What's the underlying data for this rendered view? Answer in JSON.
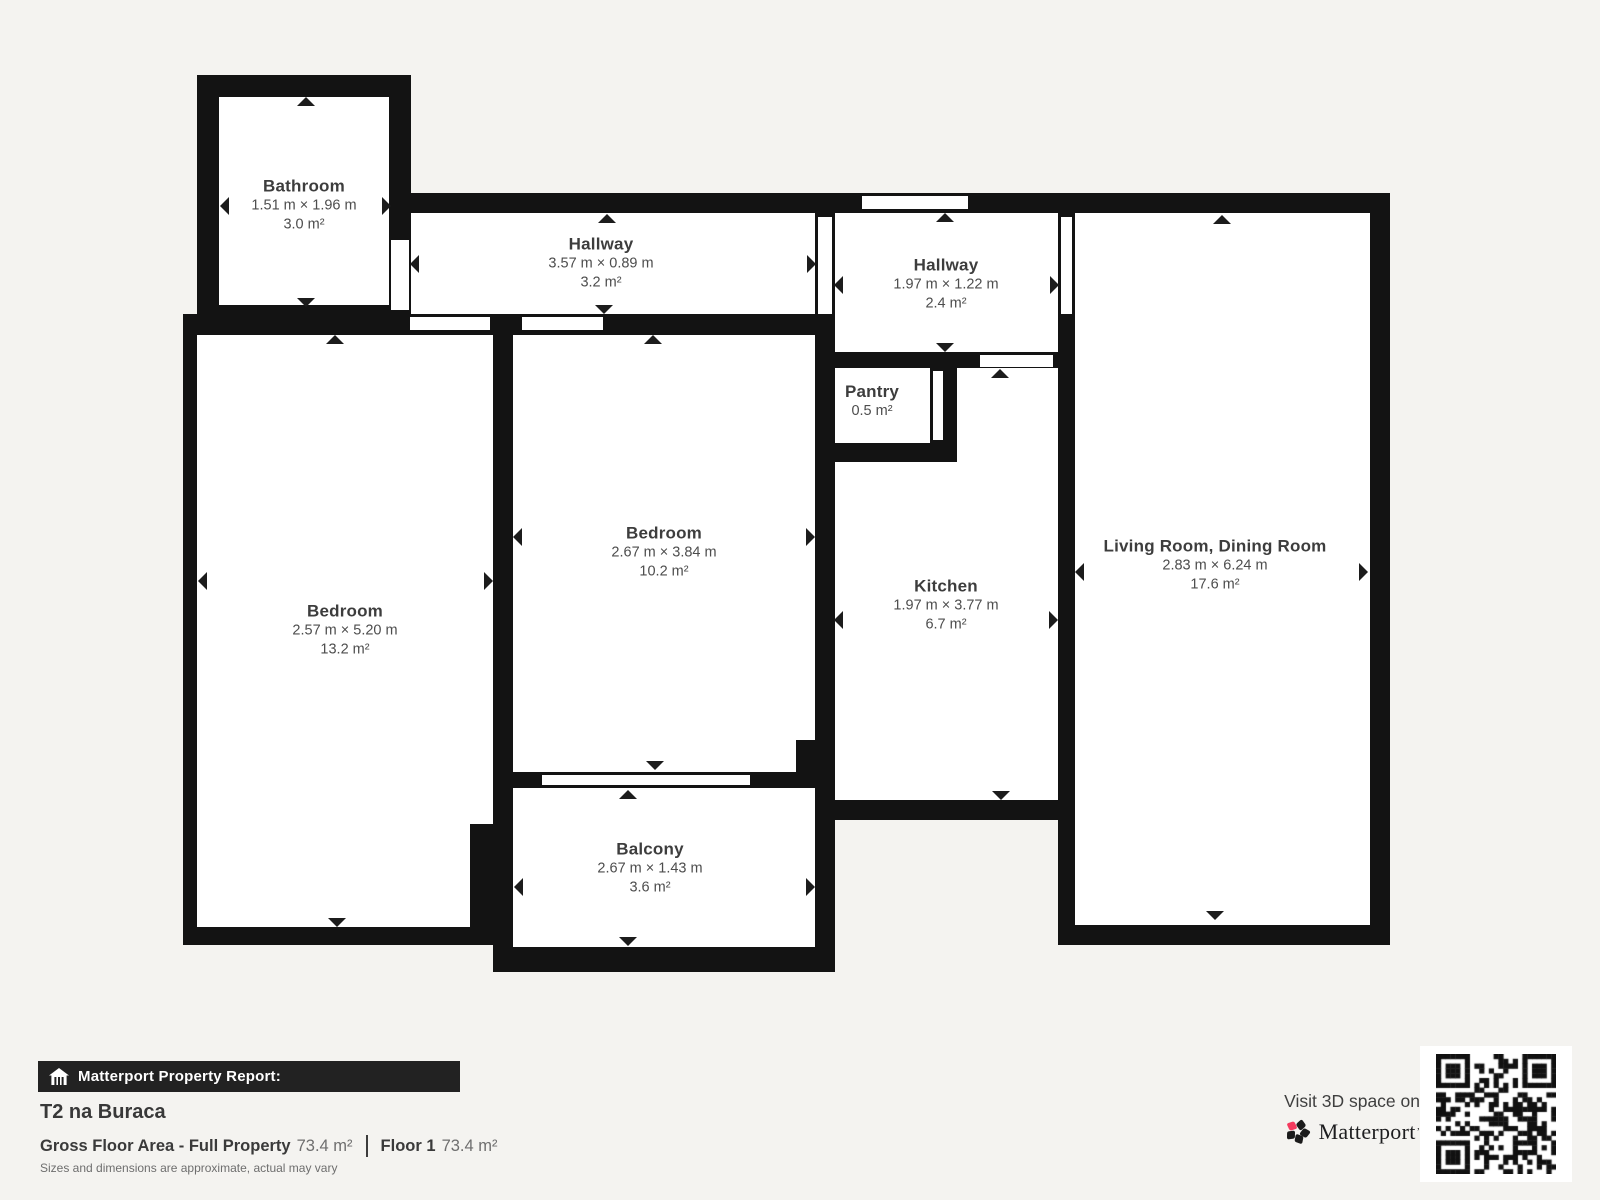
{
  "plan": {
    "rooms": [
      {
        "name": "Bathroom",
        "dims": "1.51 m × 1.96 m",
        "area": "3.0 m²"
      },
      {
        "name": "Hallway",
        "dims": "3.57 m × 0.89 m",
        "area": "3.2 m²"
      },
      {
        "name": "Hallway",
        "dims": "1.97 m × 1.22 m",
        "area": "2.4 m²"
      },
      {
        "name": "Pantry",
        "area": "0.5 m²"
      },
      {
        "name": "Bedroom",
        "dims": "2.57 m × 5.20 m",
        "area": "13.2 m²"
      },
      {
        "name": "Bedroom",
        "dims": "2.67 m × 3.84 m",
        "area": "10.2 m²"
      },
      {
        "name": "Kitchen",
        "dims": "1.97 m × 3.77 m",
        "area": "6.7 m²"
      },
      {
        "name": "Living Room, Dining Room",
        "dims": "2.83 m × 6.24 m",
        "area": "17.6 m²"
      },
      {
        "name": "Balcony",
        "dims": "2.67 m × 1.43 m",
        "area": "3.6 m²"
      }
    ]
  },
  "report": {
    "bar_label": "Matterport Property Report:",
    "property_name": "T2 na Buraca",
    "gfa_label": "Gross Floor Area - Full Property",
    "gfa_value": "73.4 m²",
    "floor_label": "Floor 1",
    "floor_value": "73.4 m²",
    "disclaimer": "Sizes and dimensions are approximate, actual may vary"
  },
  "promo": {
    "visit_text": "Visit 3D space on",
    "brand": "Matterport"
  },
  "icons": {
    "report_bar": "house-icon",
    "brand": "matterport-pinwheel-icon",
    "qr": "qr-code-icon"
  },
  "colors": {
    "background": "#f4f3f0",
    "wall": "#131313",
    "room_fill": "#ffffff",
    "label": "#3d3d3d",
    "dims": "#4d4d4d",
    "bar_bg": "#222222",
    "logo_pink": "#f43a5e"
  }
}
